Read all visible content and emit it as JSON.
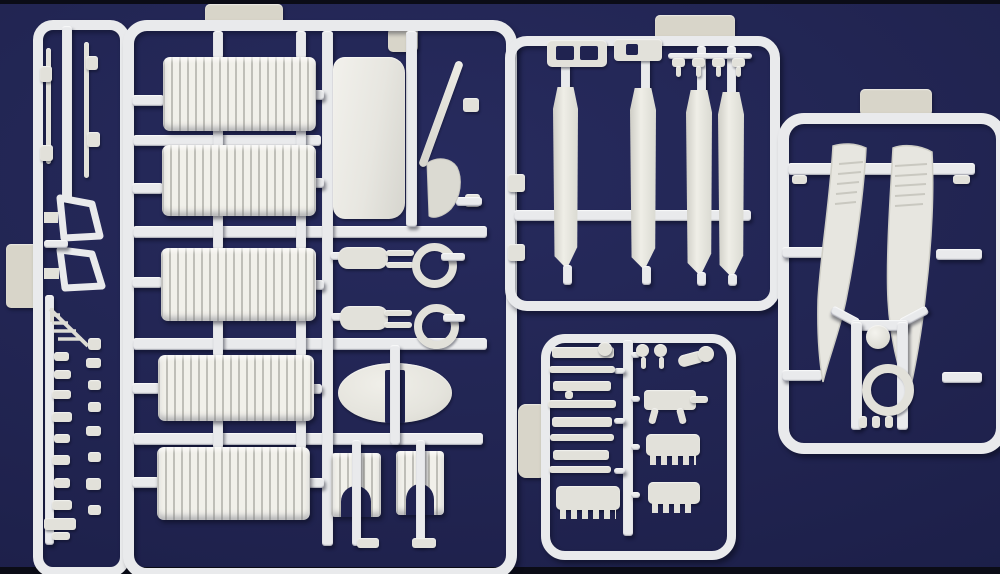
{
  "scene": {
    "type": "product-photograph",
    "description": "Five white injection-molded plastic sprues (model aircraft kit runners) laid on a dark navy background"
  },
  "colors": {
    "bg-center": "#272b5e",
    "bg-mid": "#20234f",
    "bg-edge": "#181b42",
    "strip": "#0b0c16",
    "runner": "#e9eaec",
    "part": "#e2e1da",
    "part-bright": "#f1f0ea",
    "part-shadow": "#c2c1b8",
    "tab": "#d8d5c9",
    "cutout": "#202350"
  },
  "sprues": [
    {
      "id": "left",
      "name": "small-parts-runner",
      "parts": [
        "interplane-struts",
        "cabane-frame",
        "cabane-frame",
        "boarding-ladder",
        "small-fittings"
      ]
    },
    {
      "id": "main",
      "name": "main-runner",
      "parts": [
        "corrugated-wing-panel",
        "corrugated-wing-panel",
        "corrugated-wing-panel",
        "corrugated-wing-panel",
        "corrugated-wing-panel",
        "center-section-panel",
        "propeller-blade",
        "fin",
        "engine-nacelle",
        "cowl-ring",
        "engine-nacelle",
        "cowl-ring",
        "stabilizer-oval",
        "wheel-spat",
        "wheel-spat"
      ]
    },
    {
      "id": "top-right",
      "name": "float-sides-runner",
      "parts": [
        "float-side",
        "float-side",
        "float-side",
        "float-side",
        "windscreen",
        "small-clips"
      ]
    },
    {
      "id": "right",
      "name": "float-halves-runner",
      "parts": [
        "float-half",
        "float-half",
        "ball-fitting",
        "cowl-ring"
      ]
    },
    {
      "id": "bottom-center",
      "name": "detail-parts-runner",
      "parts": [
        "machine-gun",
        "rods",
        "gun-mount",
        "finned-engine-block",
        "finned-engine-block",
        "finned-engine-block",
        "horn",
        "bolts"
      ]
    }
  ]
}
